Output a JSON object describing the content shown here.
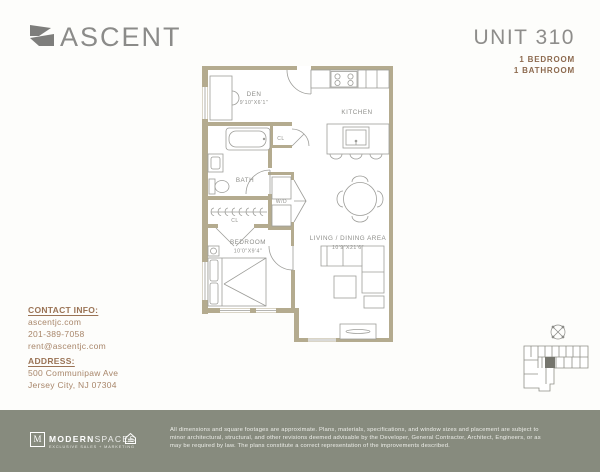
{
  "brand": {
    "name": "ASCENT"
  },
  "unit": {
    "title": "UNIT 310",
    "bedroom": "1 BEDROOM",
    "bathroom": "1 BATHROOM"
  },
  "plan": {
    "den": {
      "label": "DEN",
      "dims": "9'10\"X6'1\""
    },
    "kitchen": {
      "label": "KITCHEN"
    },
    "bath": {
      "label": "BATH"
    },
    "cl_bath": {
      "label": "CL"
    },
    "cl_hall": {
      "label": "CL"
    },
    "wd": {
      "label": "W/D"
    },
    "bedroom": {
      "label": "BEDROOM",
      "dims": "10'0\"X9'4\""
    },
    "living": {
      "label": "LIVING / DINING AREA",
      "dims": "10'9\"X21'6\""
    }
  },
  "contact": {
    "heading": "CONTACT INFO:",
    "website": "ascentjc.com",
    "phone": "201-389-7058",
    "email": "rent@ascentjc.com"
  },
  "address": {
    "heading": "ADDRESS:",
    "line1": "500 Communipaw Ave",
    "line2": "Jersey City, NJ 07304"
  },
  "footer": {
    "logo": {
      "initial": "M",
      "brand_bold": "MODERN",
      "brand_light": "SPACES",
      "tagline": "EXCLUSIVE SALES + MARKETING"
    },
    "disclaimer": "All dimensions and square footages are approximate. Plans, materials, specifications, and window sizes and placement are subject to minor architectural, structural, and other revisions deemed advisable by the Developer, General Contractor, Architect, Engineers, or as may be required by law. The plans constitute a correct representation of the improvements described."
  },
  "colors": {
    "wall": "#b4ab8f",
    "accent_brown": "#8d6a4f",
    "text_gray": "#8e8e8a",
    "footer_bg": "#878b7e"
  }
}
